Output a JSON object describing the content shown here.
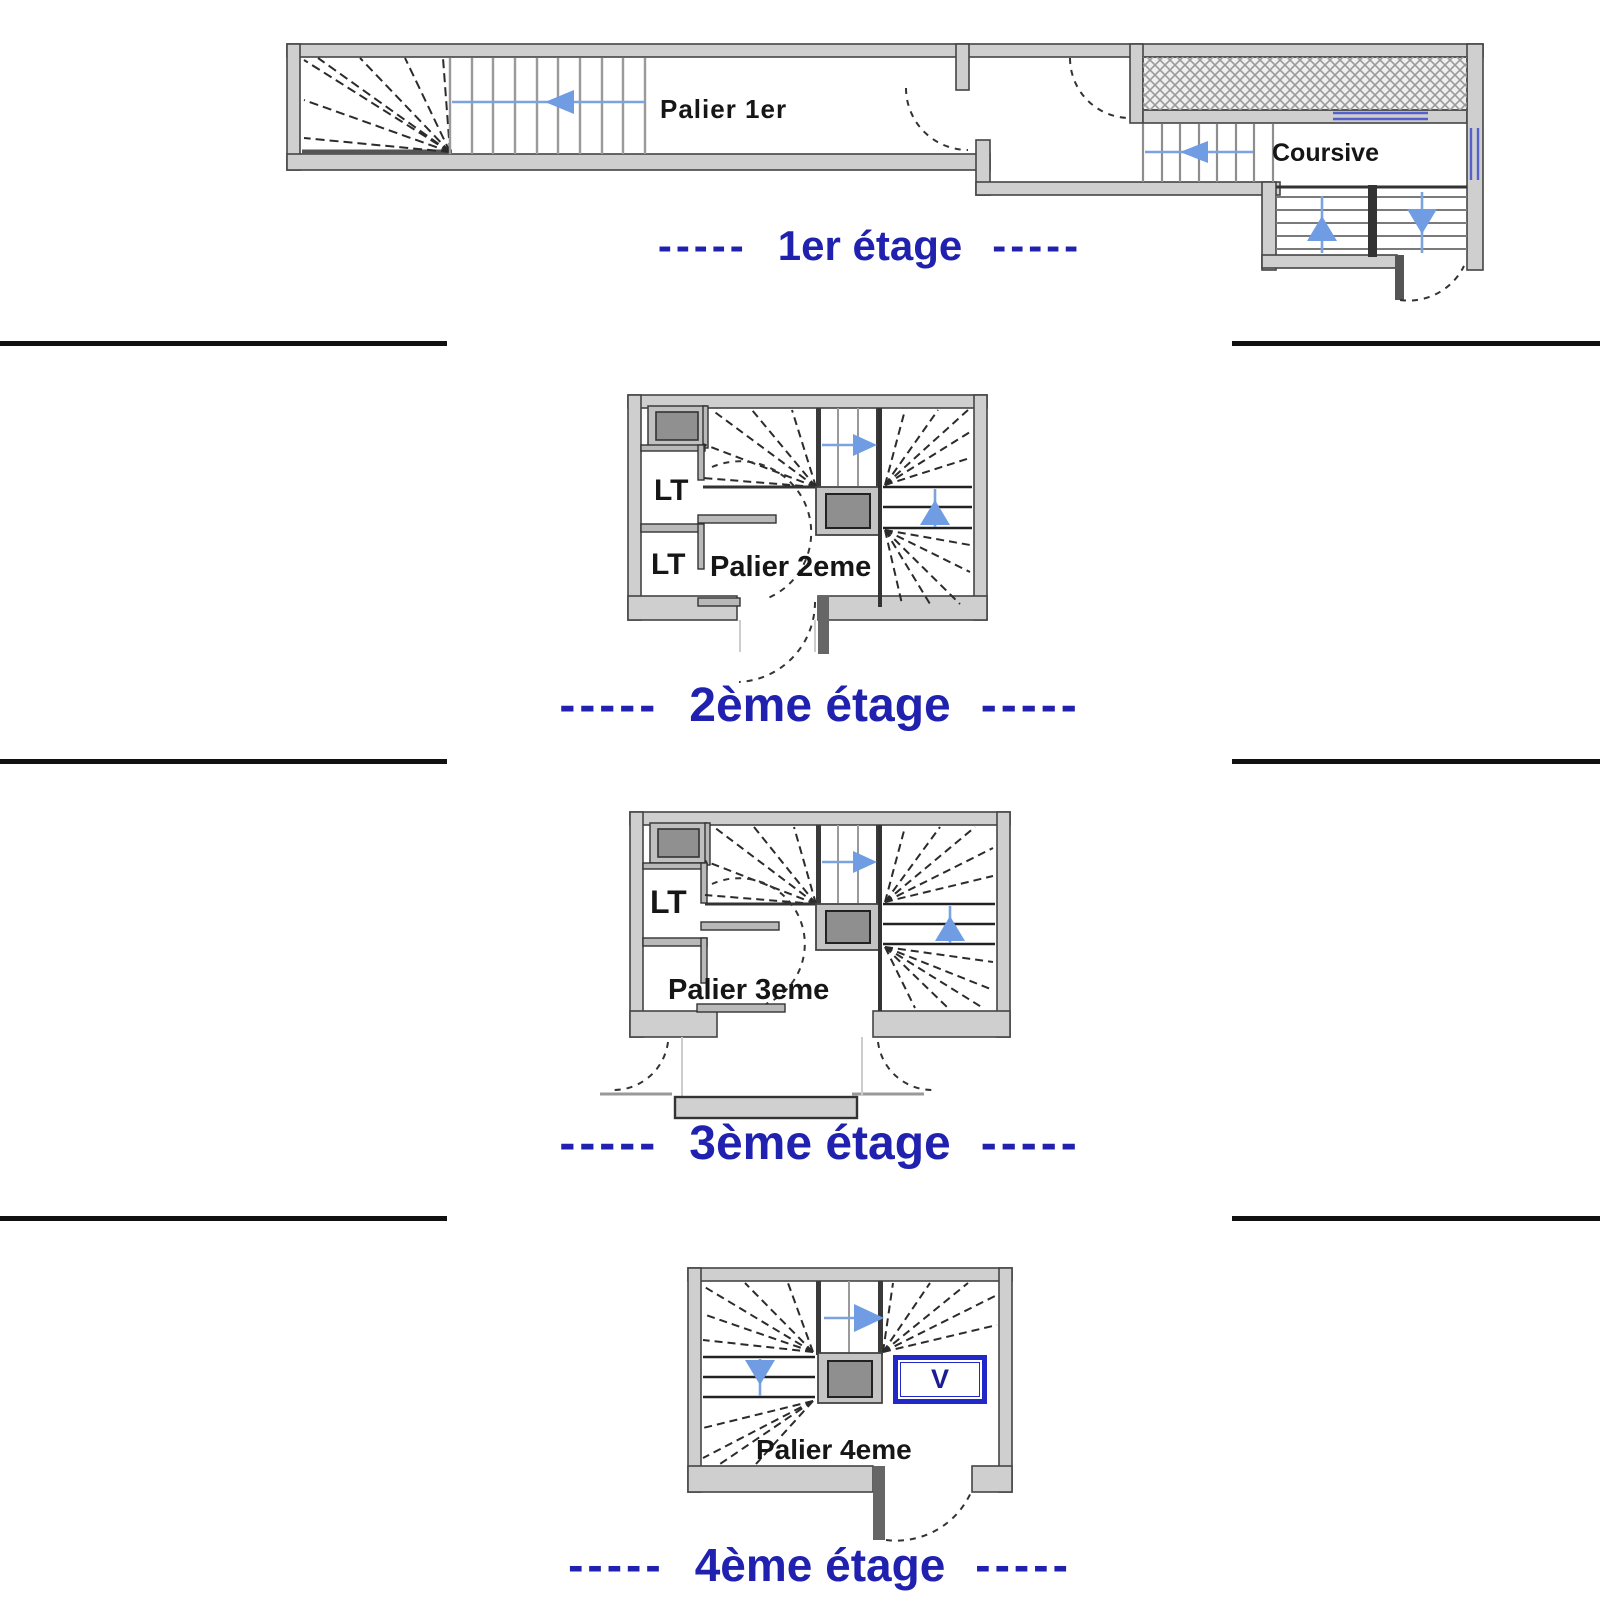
{
  "colors": {
    "caption_blue": "#2121af",
    "arrow_blue": "#6f9ce3",
    "wall_gray": "#cfcfcf",
    "wall_outline": "#444444",
    "v_box_blue": "#2228c8"
  },
  "captions": {
    "dashes": "-----",
    "floor1": "1er étage",
    "floor2": "2ème étage",
    "floor3": "3ème étage",
    "floor4": "4ème étage"
  },
  "floor1": {
    "palier": "Palier 1er",
    "coursive": "Coursive"
  },
  "floor2": {
    "lt_top": "LT",
    "lt_bottom": "LT",
    "palier": "Palier 2eme"
  },
  "floor3": {
    "lt": "LT",
    "palier": "Palier 3eme"
  },
  "floor4": {
    "palier": "Palier 4eme",
    "v_marker": "V"
  }
}
